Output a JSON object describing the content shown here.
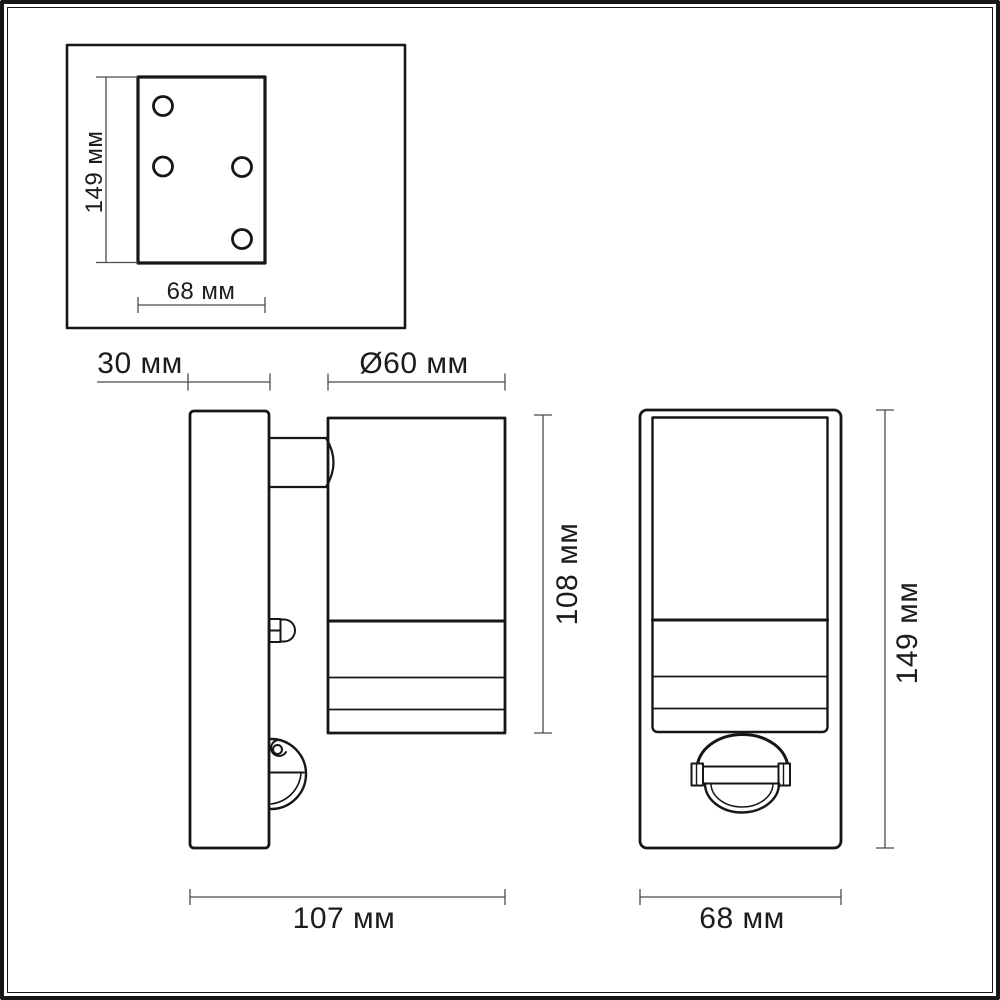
{
  "page": {
    "background_color": "#ffffff",
    "line_color": "#161616",
    "dimension_line_color": "#4a4a4a",
    "text_color": "#1c1c1c"
  },
  "mounting_plate_view": {
    "height_label": "149 мм",
    "width_label": "68 мм"
  },
  "side_view": {
    "wall_plate_depth_label": "30 мм",
    "body_diameter_label": "Ø60 мм",
    "body_height_label": "108 мм",
    "overall_depth_label": "107 мм"
  },
  "front_view": {
    "height_label": "149 мм",
    "width_label": "68 мм"
  }
}
